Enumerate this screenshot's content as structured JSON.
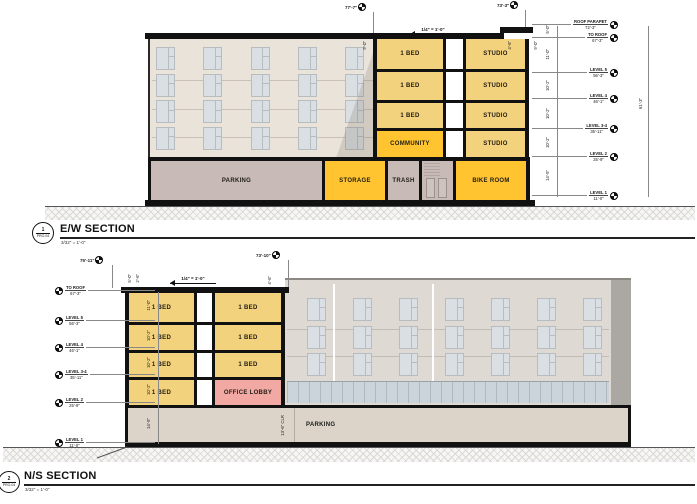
{
  "ew": {
    "ref": "1",
    "sheet": "PRO.04",
    "title": "E/W SECTION",
    "scale": "3/32\" = 1'-0\"",
    "marker_top_left": "77'-7\"",
    "marker_top_right": "73'-3\"",
    "slope": "1/4\" = 1'-0\"",
    "pdim1": "9'-0\"",
    "pdim2": "4'-6\"",
    "pdim3": "9'-0\"",
    "overall": "61'-3\"",
    "floors": [
      {
        "left": "1 BED",
        "right": "STUDIO"
      },
      {
        "left": "1 BED",
        "right": "STUDIO"
      },
      {
        "left": "1 BED",
        "right": "STUDIO"
      },
      {
        "left": "COMMUNITY",
        "right": "STUDIO"
      }
    ],
    "basement": {
      "parking": "PARKING",
      "storage": "STORAGE",
      "trash": "TRASH",
      "bike": "BIKE ROOM"
    },
    "levels": [
      {
        "name": "ROOF PARAPET",
        "elev": "72'-3\""
      },
      {
        "name": "TO ROOF",
        "elev": "67'-3\""
      },
      {
        "name": "LEVEL 5",
        "elev": "56'-3\""
      },
      {
        "name": "LEVEL 4",
        "elev": "46'-1\""
      },
      {
        "name": "LEVEL 3-4",
        "elev": "35'-11\""
      },
      {
        "name": "LEVEL 2",
        "elev": "25'-9\""
      },
      {
        "name": "LEVEL 1",
        "elev": "11'-0\""
      }
    ],
    "floor_dims": [
      "5'-0\"",
      "11'-0\"",
      "10'-2\"",
      "10'-2\"",
      "10'-2\"",
      "14'-9\""
    ]
  },
  "ns": {
    "ref": "2",
    "sheet": "PRO.04",
    "title": "N/S SECTION",
    "scale": "3/32\" = 1'-0\"",
    "marker_top_left": "75'-11\"",
    "marker_top_right": "73'-10\"",
    "slope": "1/4\" = 1'-0\"",
    "pdim1": "5'-0\"",
    "pdim2": "2'-6\"",
    "pdim3": "4'-6\"",
    "parking": "PARKING",
    "parking_clr": "13'-6\" CLR",
    "floors": [
      {
        "left": "1 BED",
        "right": "1 BED"
      },
      {
        "left": "1 BED",
        "right": "1 BED"
      },
      {
        "left": "1 BED",
        "right": "1 BED"
      },
      {
        "left": "1 BED",
        "right": "OFFICE LOBBY"
      }
    ],
    "levels": [
      {
        "name": "TO ROOF",
        "elev": "67'-3\""
      },
      {
        "name": "LEVEL 5",
        "elev": "56'-3\""
      },
      {
        "name": "LEVEL 4",
        "elev": "46'-1\""
      },
      {
        "name": "LEVEL 3-4",
        "elev": "35'-11\""
      },
      {
        "name": "LEVEL 2",
        "elev": "25'-9\""
      },
      {
        "name": "LEVEL 1",
        "elev": "11'-0\""
      }
    ],
    "floor_dims": [
      "11'-0\"",
      "10'-2\"",
      "10'-2\"",
      "10'-2\"",
      "14'-9\""
    ]
  }
}
